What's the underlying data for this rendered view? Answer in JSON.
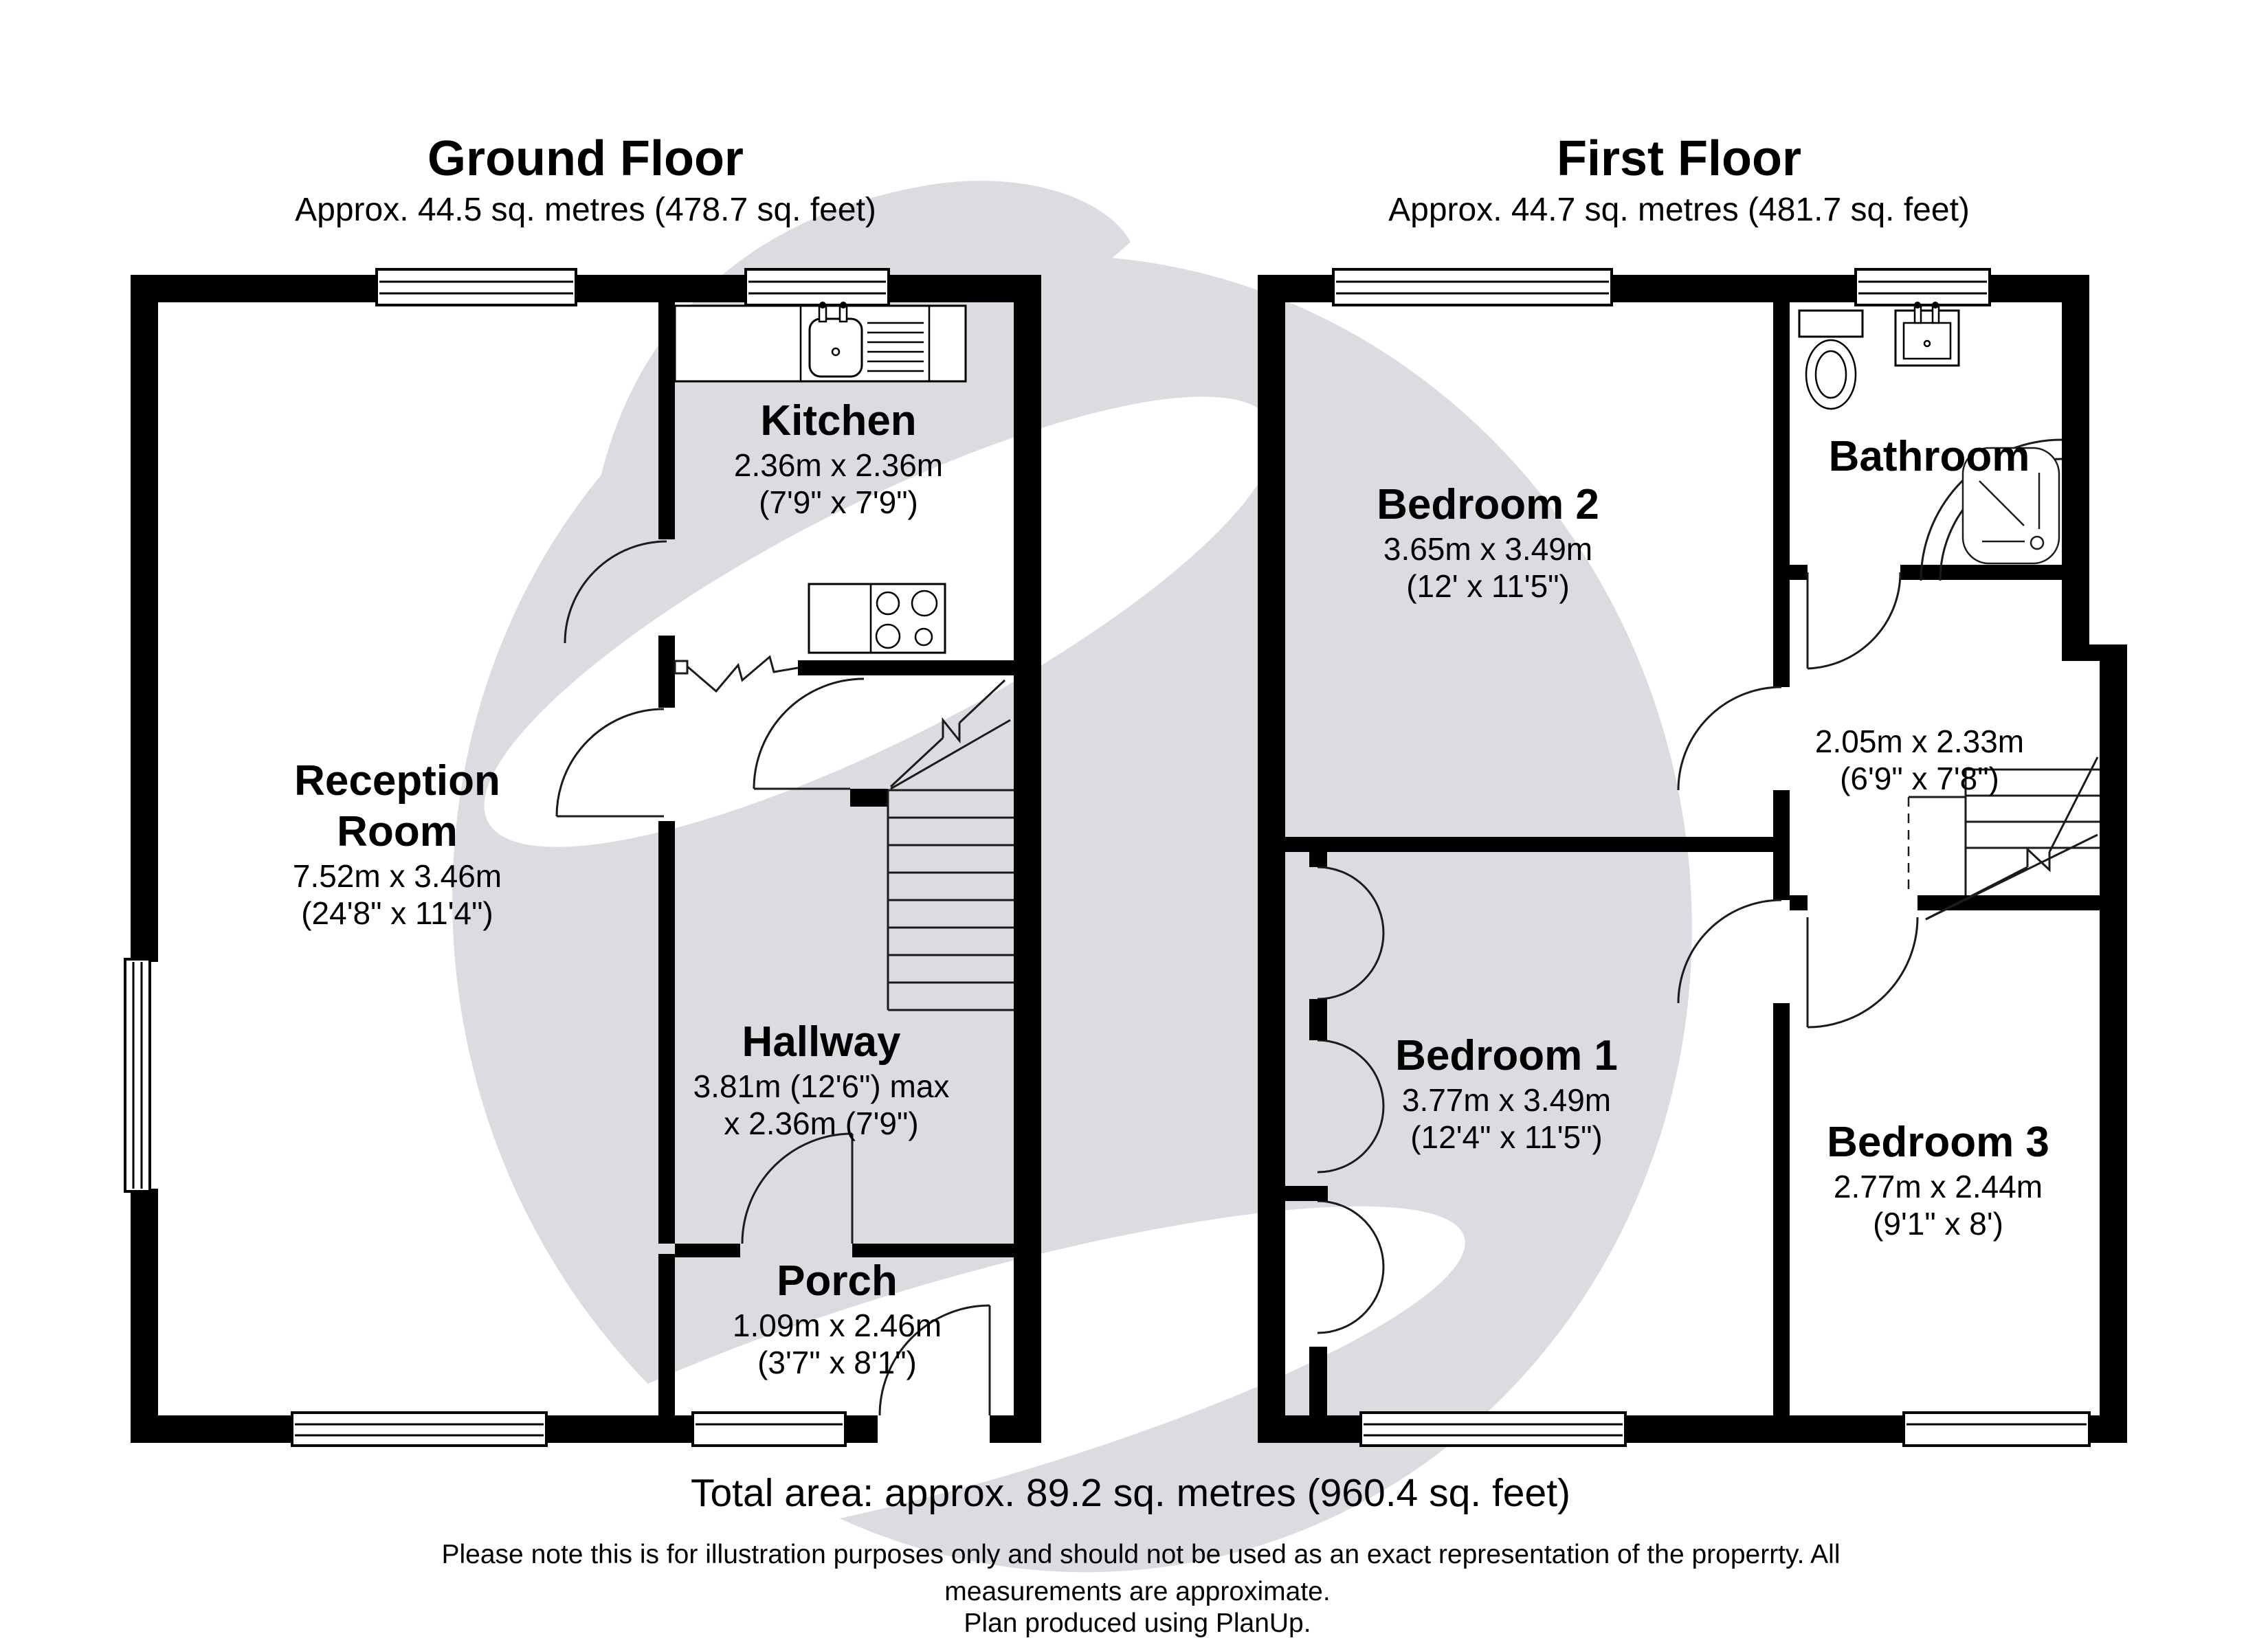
{
  "colors": {
    "wall": "#000000",
    "thin_line": "#1b1b1b",
    "watermark": "#dcdbe1",
    "background": "#ffffff",
    "text": "#000000"
  },
  "ground_floor": {
    "title": "Ground Floor",
    "subtitle": "Approx. 44.5 sq. metres (478.7 sq. feet)",
    "rooms": {
      "kitchen": {
        "name": "Kitchen",
        "dims": [
          "2.36m x 2.36m",
          "(7'9\" x 7'9\")"
        ]
      },
      "reception": {
        "name": "Reception Room",
        "dims": [
          "7.52m x 3.46m",
          "(24'8\" x 11'4\")"
        ]
      },
      "hallway": {
        "name": "Hallway",
        "dims": [
          "3.81m (12'6\") max",
          "x 2.36m (7'9\")"
        ]
      },
      "porch": {
        "name": "Porch",
        "dims": [
          "1.09m x 2.46m",
          "(3'7\" x 8'1\")"
        ]
      }
    }
  },
  "first_floor": {
    "title": "First Floor",
    "subtitle": "Approx. 44.7 sq. metres (481.7 sq. feet)",
    "rooms": {
      "bedroom2": {
        "name": "Bedroom 2",
        "dims": [
          "3.65m x 3.49m",
          "(12' x 11'5\")"
        ]
      },
      "bathroom": {
        "name": "Bathroom",
        "dims": []
      },
      "landing": {
        "name": "",
        "dims": [
          "2.05m x 2.33m",
          "(6'9\" x 7'8\")"
        ]
      },
      "bedroom1": {
        "name": "Bedroom 1",
        "dims": [
          "3.77m x 3.49m",
          "(12'4\" x 11'5\")"
        ]
      },
      "bedroom3": {
        "name": "Bedroom 3",
        "dims": [
          "2.77m x 2.44m",
          "(9'1\" x 8')"
        ]
      }
    }
  },
  "footer": {
    "total_area": "Total area: approx. 89.2 sq. metres (960.4 sq. feet)",
    "disclaimer": [
      "Please note this is for illustration purposes only and should not be used as an exact representation of the properrty. All",
      "measurements are approximate.",
      "Plan produced using PlanUp."
    ]
  }
}
